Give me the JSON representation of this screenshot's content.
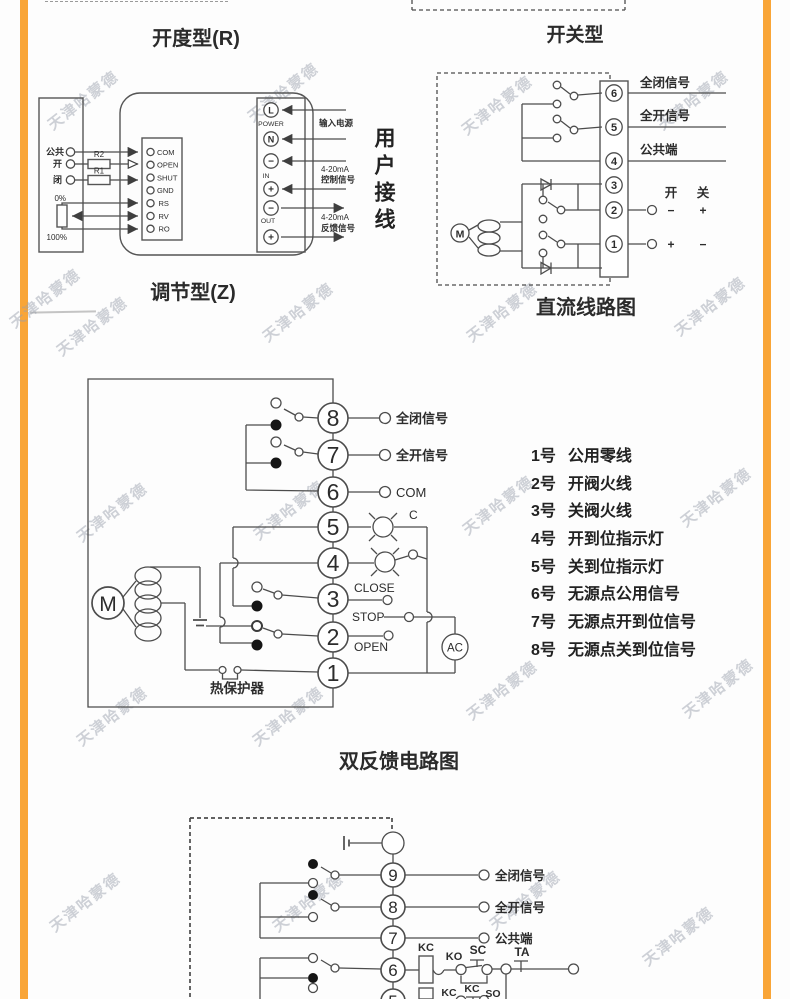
{
  "watermark": {
    "text": "天津哈蒙德"
  },
  "r": {
    "title": "开度型(R)",
    "caption": "调节型(Z)",
    "left": {
      "common": "公共",
      "open": "开",
      "close": "闭",
      "r2": "R2",
      "r1": "R1",
      "p0": "0%",
      "p100": "100%"
    },
    "pins": [
      "COM",
      "OPEN",
      "SHUT",
      "GND",
      "RS",
      "RV",
      "RO"
    ],
    "term": [
      "L",
      "N",
      "−",
      "+",
      "−",
      "+"
    ],
    "power_label": "POWER",
    "in_label": "IN",
    "out_label": "OUT",
    "supply": "输入电源",
    "ma_ctrl": "4-20mA",
    "ctrl": "控制信号",
    "ma_fb": "4-20mA",
    "fb": "反馈信号",
    "user": "用户接线"
  },
  "dc": {
    "title": "开关型",
    "caption": "直流线路图",
    "term": [
      "6",
      "5",
      "4",
      "3",
      "2",
      "1"
    ],
    "sig_close": "全闭信号",
    "sig_open": "全开信号",
    "common": "公共端",
    "open": "开",
    "close": "关",
    "minus": "−",
    "plus": "+",
    "motor": "M"
  },
  "fb": {
    "caption": "双反馈电路图",
    "term": [
      "8",
      "7",
      "6",
      "5",
      "4",
      "3",
      "2",
      "1"
    ],
    "sig_close": "全闭信号",
    "sig_open": "全开信号",
    "com": "COM",
    "c": "C",
    "close": "CLOSE",
    "stop": "STOP",
    "open": "OPEN",
    "ac": "AC",
    "motor": "M",
    "thermal": "热保护器",
    "legend": [
      {
        "no": "1号",
        "text": "公用零线"
      },
      {
        "no": "2号",
        "text": "开阀火线"
      },
      {
        "no": "3号",
        "text": "关阀火线"
      },
      {
        "no": "4号",
        "text": "开到位指示灯"
      },
      {
        "no": "5号",
        "text": "关到位指示灯"
      },
      {
        "no": "6号",
        "text": "无源点公用信号"
      },
      {
        "no": "7号",
        "text": "无源点开到位信号"
      },
      {
        "no": "8号",
        "text": "无源点关到位信号"
      }
    ]
  },
  "db": {
    "term": [
      "9",
      "8",
      "7",
      "6",
      "5"
    ],
    "sig_close": "全闭信号",
    "sig_open": "全开信号",
    "common": "公共端",
    "kc": "KC",
    "ko": "KO",
    "sc": "SC",
    "ta": "TA",
    "kc2": "KC",
    "kc3": "KC",
    "so": "SO"
  }
}
